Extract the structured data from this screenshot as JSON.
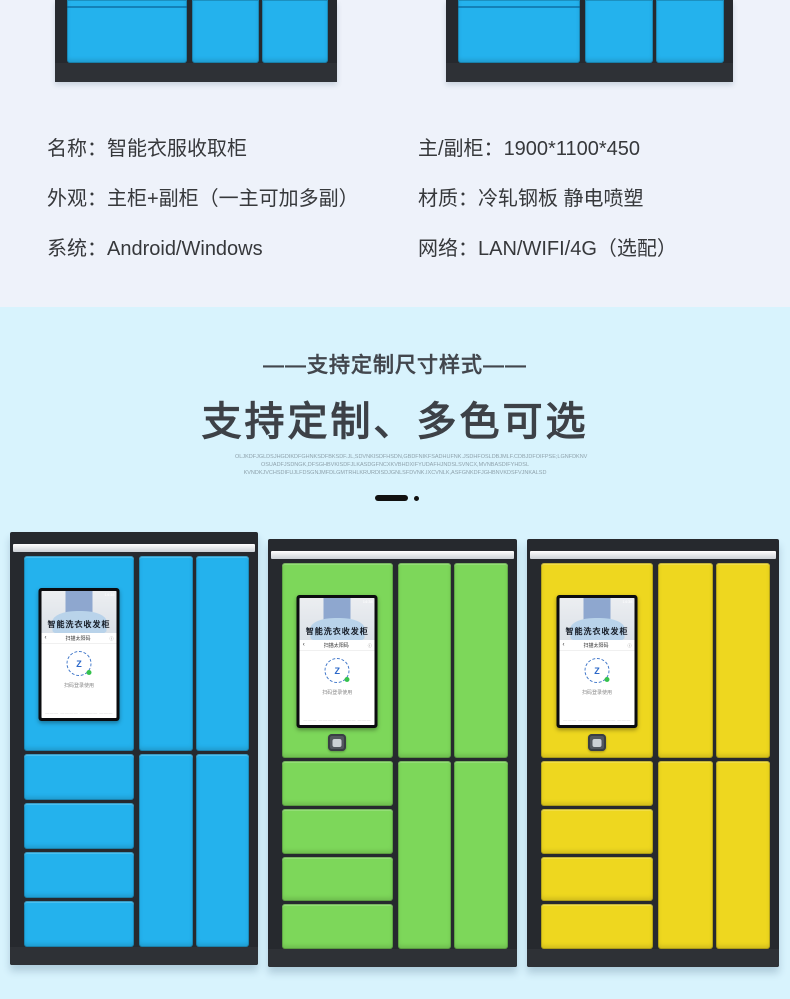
{
  "specs": {
    "left": [
      {
        "label": "名称：",
        "value": "智能衣服收取柜"
      },
      {
        "label": "外观：",
        "value": "主柜+副柜（一主可加多副）"
      },
      {
        "label": "系统：",
        "value": "Android/Windows"
      }
    ],
    "right": [
      {
        "label": "主/副柜：",
        "value": "1900*1100*450"
      },
      {
        "label": "材质：",
        "value": "冷轧钢板 静电喷塑"
      },
      {
        "label": "网络：",
        "value": "LAN/WIFI/4G（选配）"
      }
    ]
  },
  "banner": {
    "subtitle": "——支持定制尺寸样式——",
    "title": "支持定制、多色可选",
    "fineprint_lines": [
      "OLJKDFJGLDSJHGDIKDFGHNKSDFBKSDF.JL,SDVNKISDFHSDN,GBDFNIKFSADHUFNK.JSDHFOSLDBJMLF.CDBJDFOIFPSE;LGNFDKNV",
      "OSUADFJSDNGK,DFSGHBVKISDFJLKASDGFNCXKVBHDXIFYUDAFHJNDSLSVNCX,MVNBASDIFYHDSL",
      "KVNDKJVCHSDIFUJLFDSGNJMFDLGMTRHLKRURDISDJGNLSFDVNK.IXCVNLK,ASFGNKDFJGHBNVKDSFVJNKALSD"
    ]
  },
  "screen": {
    "time": "14:38",
    "photo_title": "智能洗衣收发柜",
    "back_glyph": "‹",
    "header_title": "扫描太阳码",
    "info_glyph": "ⓘ",
    "emblem_letter": "Z",
    "caption": "扫码登录使用",
    "footer": "——— ———— ———— ———"
  },
  "lockers": [
    {
      "name": "locker-blue",
      "color_name": "blue",
      "door_color": "#24b2ed",
      "seam_color": "#0d85c2",
      "has_button": false
    },
    {
      "name": "locker-green",
      "color_name": "green",
      "door_color": "#7dd75a",
      "seam_color": "#43a52e",
      "has_button": true
    },
    {
      "name": "locker-yellow",
      "color_name": "yellow",
      "door_color": "#eed71f",
      "seam_color": "#b99f0e",
      "has_button": true
    }
  ],
  "colors": {
    "top_bg": "#eef2fa",
    "banner_bg": "#d8f3fd",
    "frame": "#26292e",
    "base": "#2e3136",
    "blue_door": "#24b2ed",
    "ink": "#111111",
    "text_dark": "#36383b"
  }
}
